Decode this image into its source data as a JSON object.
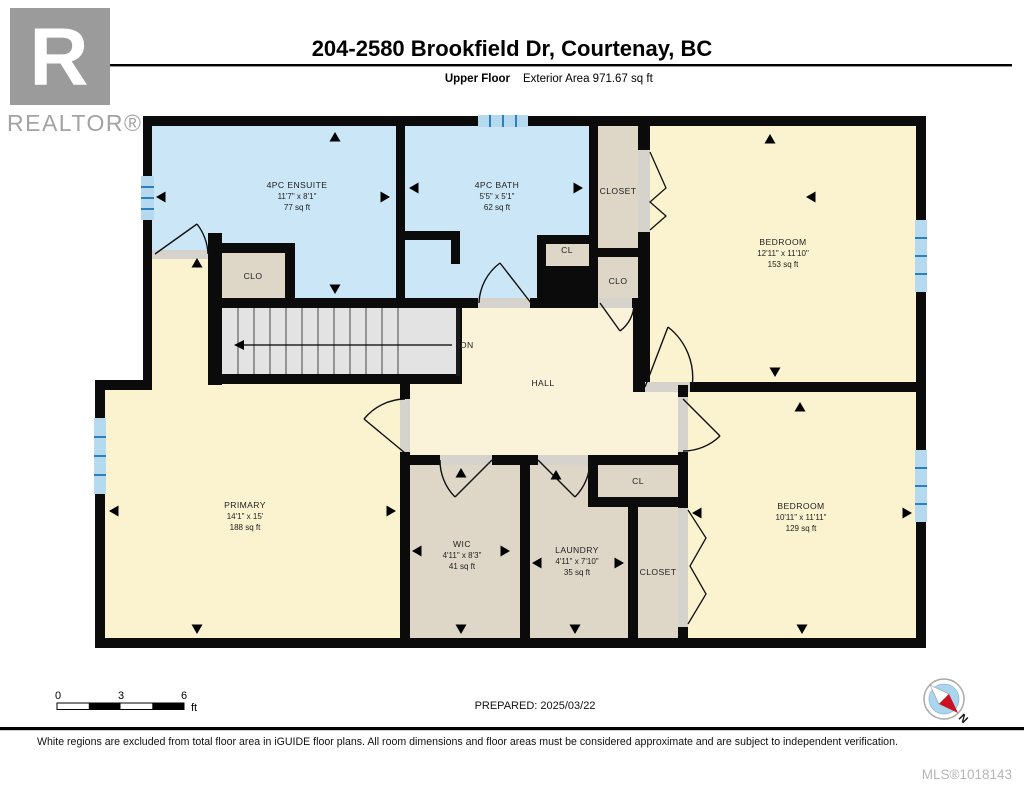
{
  "header": {
    "logo_r": "R",
    "realtor_label": "REALTOR®",
    "title": "204-2580 Brookfield Dr, Courtenay, BC",
    "floor_label": "Upper Floor",
    "area_label": "Exterior Area 971.67 sq ft"
  },
  "rooms": {
    "ensuite": {
      "name": "4PC ENSUITE",
      "dims": "11'7\" x 8'1\"",
      "area": "77 sq ft"
    },
    "bath": {
      "name": "4PC BATH",
      "dims": "5'5\" x 5'1\"",
      "area": "62 sq ft"
    },
    "closet_top": {
      "name": "CLOSET"
    },
    "cl_mid": {
      "name": "CL"
    },
    "clo_right": {
      "name": "CLO"
    },
    "clo_left": {
      "name": "CLO"
    },
    "bedroom_top": {
      "name": "BEDROOM",
      "dims": "12'11\" x 11'10\"",
      "area": "153 sq ft"
    },
    "hall": {
      "name": "HALL"
    },
    "stairs": {
      "label": "DN"
    },
    "primary": {
      "name": "PRIMARY",
      "dims": "14'1\" x 15'",
      "area": "188 sq ft"
    },
    "wic": {
      "name": "WIC",
      "dims": "4'11\" x 8'3\"",
      "area": "41 sq ft"
    },
    "laundry": {
      "name": "LAUNDRY",
      "dims": "4'11\" x 7'10\"",
      "area": "35 sq ft"
    },
    "cl_bottom": {
      "name": "CL"
    },
    "closet_bottom": {
      "name": "CLOSET"
    },
    "bedroom_bottom": {
      "name": "BEDROOM",
      "dims": "10'11\" x 11'11\"",
      "area": "129 sq ft"
    }
  },
  "scale_bar": {
    "tick_0": "0",
    "tick_3": "3",
    "tick_6": "6",
    "unit": "ft"
  },
  "compass": {
    "north_label": "N"
  },
  "footer": {
    "prepared_label": "PREPARED: 2025/03/22",
    "disclaimer": "White regions are excluded from total floor area in iGUIDE floor plans. All room dimensions and floor areas must be considered approximate and are subject to independent verification.",
    "mls_label": "MLS®1018143"
  },
  "colors": {
    "wall": "#0b0b0b",
    "bath_fill": "#cbe6f7",
    "room_fill": "#fbf2d0",
    "hall_fill": "#faf3da",
    "closet_fill": "#ded7c8",
    "stairs_fill": "#e3e3e3",
    "window_blue": "#2f7fbe",
    "logo_gray": "#9b9b9b",
    "mls_gray": "#b5b5b5"
  }
}
